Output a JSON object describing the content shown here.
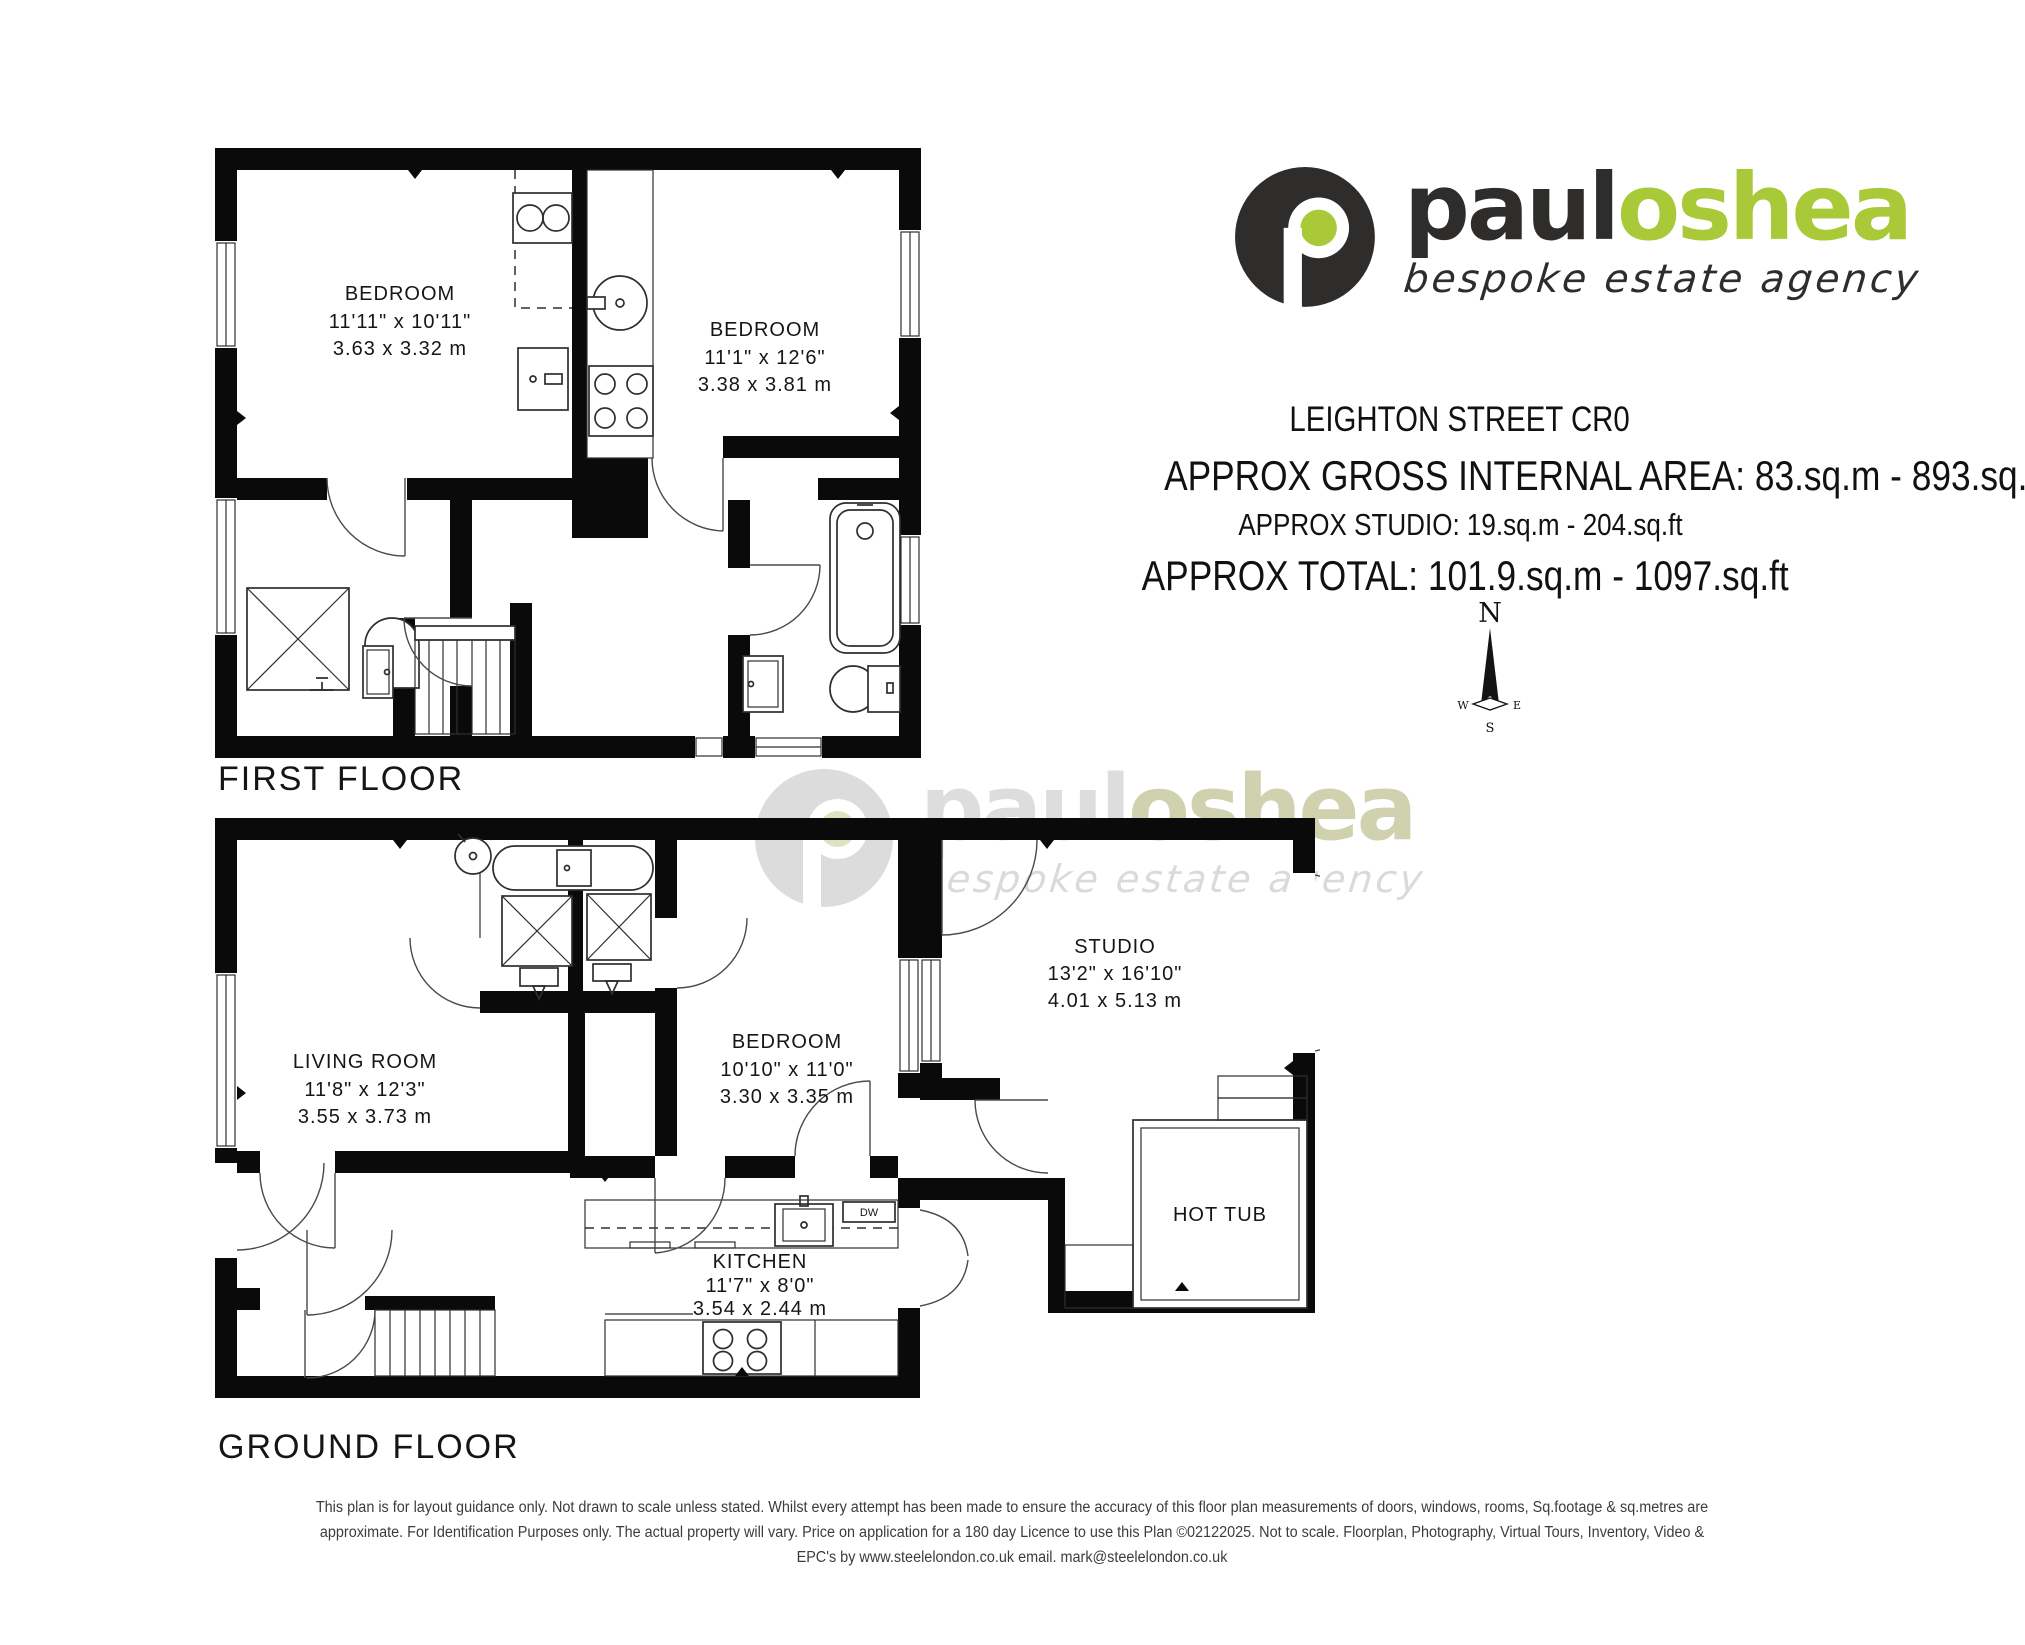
{
  "branding": {
    "word_dark": "paul",
    "word_green": "oshea",
    "tagline": "bespoke estate agency",
    "brand_green": "#a9c938",
    "brand_dark": "#2e2d2c"
  },
  "header": {
    "address": "LEIGHTON STREET CR0",
    "gross_area": "APPROX GROSS INTERNAL AREA: 83.sq.m - 893.sq.ft",
    "studio_area": "APPROX STUDIO: 19.sq.m - 204.sq.ft",
    "total_area": "APPROX TOTAL: 101.9.sq.m - 1097.sq.ft"
  },
  "compass": {
    "north": "N",
    "east": "E",
    "south": "S",
    "west": "W"
  },
  "floors": {
    "first": {
      "label": "FIRST FLOOR",
      "rooms": [
        {
          "name": "BEDROOM",
          "imperial": "11'11\" x 10'11\"",
          "metric": "3.63 x 3.32 m"
        },
        {
          "name": "BEDROOM",
          "imperial": "11'1\" x 12'6\"",
          "metric": "3.38 x 3.81 m"
        }
      ]
    },
    "ground": {
      "label": "GROUND FLOOR",
      "rooms": [
        {
          "name": "LIVING ROOM",
          "imperial": "11'8\" x 12'3\"",
          "metric": "3.55 x 3.73 m"
        },
        {
          "name": "BEDROOM",
          "imperial": "10'10\" x 11'0\"",
          "metric": "3.30 x 3.35 m"
        },
        {
          "name": "STUDIO",
          "imperial": "13'2\" x 16'10\"",
          "metric": "4.01 x 5.13 m"
        },
        {
          "name": "KITCHEN",
          "imperial": "11'7\" x 8'0\"",
          "metric": "3.54 x 2.44 m"
        }
      ],
      "hot_tub_label": "HOT TUB",
      "dishwasher_label": "DW"
    }
  },
  "footer": {
    "disclaimer": "This plan is for layout guidance only. Not drawn to scale unless stated. Whilst every attempt has been made to ensure the accuracy of this floor plan measurements of doors, windows, rooms, Sq.footage & sq.metres are approximate. For Identification Purposes only. The actual property will vary. Price on application for a 180 day Licence to use this Plan ©02122025. Not to scale. Floorplan, Photography, Virtual Tours, Inventory, Video & EPC's by www.steelelondon.co.uk email. mark@steelelondon.co.uk"
  }
}
